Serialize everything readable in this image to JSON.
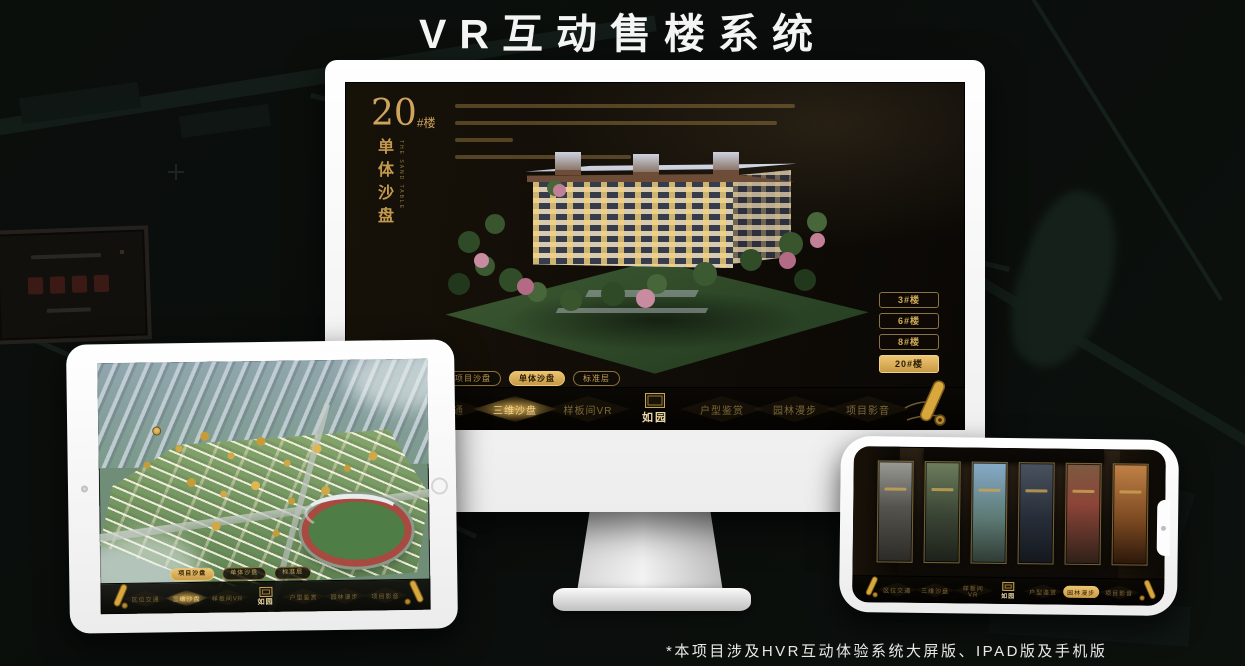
{
  "page": {
    "title": "VR互动售楼系统",
    "footnote": "*本项目涉及HVR互动体验系统大屏版、IPAD版及手机版"
  },
  "brand": {
    "logo": "如园",
    "gold": "#cfa95c"
  },
  "monitor": {
    "heading": {
      "number": "20",
      "unit": "#楼",
      "title_cn": "单体沙盘",
      "title_en": "THE SAND TABLE"
    },
    "view_tabs": [
      {
        "label": "项目沙盘",
        "active": false
      },
      {
        "label": "单体沙盘",
        "active": true
      },
      {
        "label": "标准层",
        "active": false
      }
    ],
    "floor_buttons": [
      {
        "label": "3#楼",
        "active": false
      },
      {
        "label": "6#楼",
        "active": false
      },
      {
        "label": "8#楼",
        "active": false
      },
      {
        "label": "20#楼",
        "active": true
      }
    ],
    "nav": [
      {
        "label": "区位交通",
        "active": false
      },
      {
        "label": "三维沙盘",
        "active": true
      },
      {
        "label": "样板间VR",
        "active": false
      },
      {
        "label": "户型鉴赏",
        "active": false
      },
      {
        "label": "园林漫步",
        "active": false
      },
      {
        "label": "项目影音",
        "active": false
      }
    ]
  },
  "tablet": {
    "view_tabs": [
      {
        "label": "项目沙盘",
        "active": true
      },
      {
        "label": "单体沙盘",
        "active": false
      },
      {
        "label": "标准层",
        "active": false
      }
    ],
    "nav": [
      {
        "label": "区位交通",
        "active": false
      },
      {
        "label": "三维沙盘",
        "active": true
      },
      {
        "label": "样板间VR",
        "active": false
      },
      {
        "label": "户型鉴赏",
        "active": false
      },
      {
        "label": "园林漫步",
        "active": false
      },
      {
        "label": "项目影音",
        "active": false
      }
    ]
  },
  "phone": {
    "nav": [
      {
        "label": "区位交通",
        "active": false
      },
      {
        "label": "三维沙盘",
        "active": false
      },
      {
        "label": "样板间VR",
        "active": false
      },
      {
        "label": "户型鉴赏",
        "active": false
      },
      {
        "label": "园林漫步",
        "active": true
      },
      {
        "label": "项目影音",
        "active": false
      }
    ]
  }
}
